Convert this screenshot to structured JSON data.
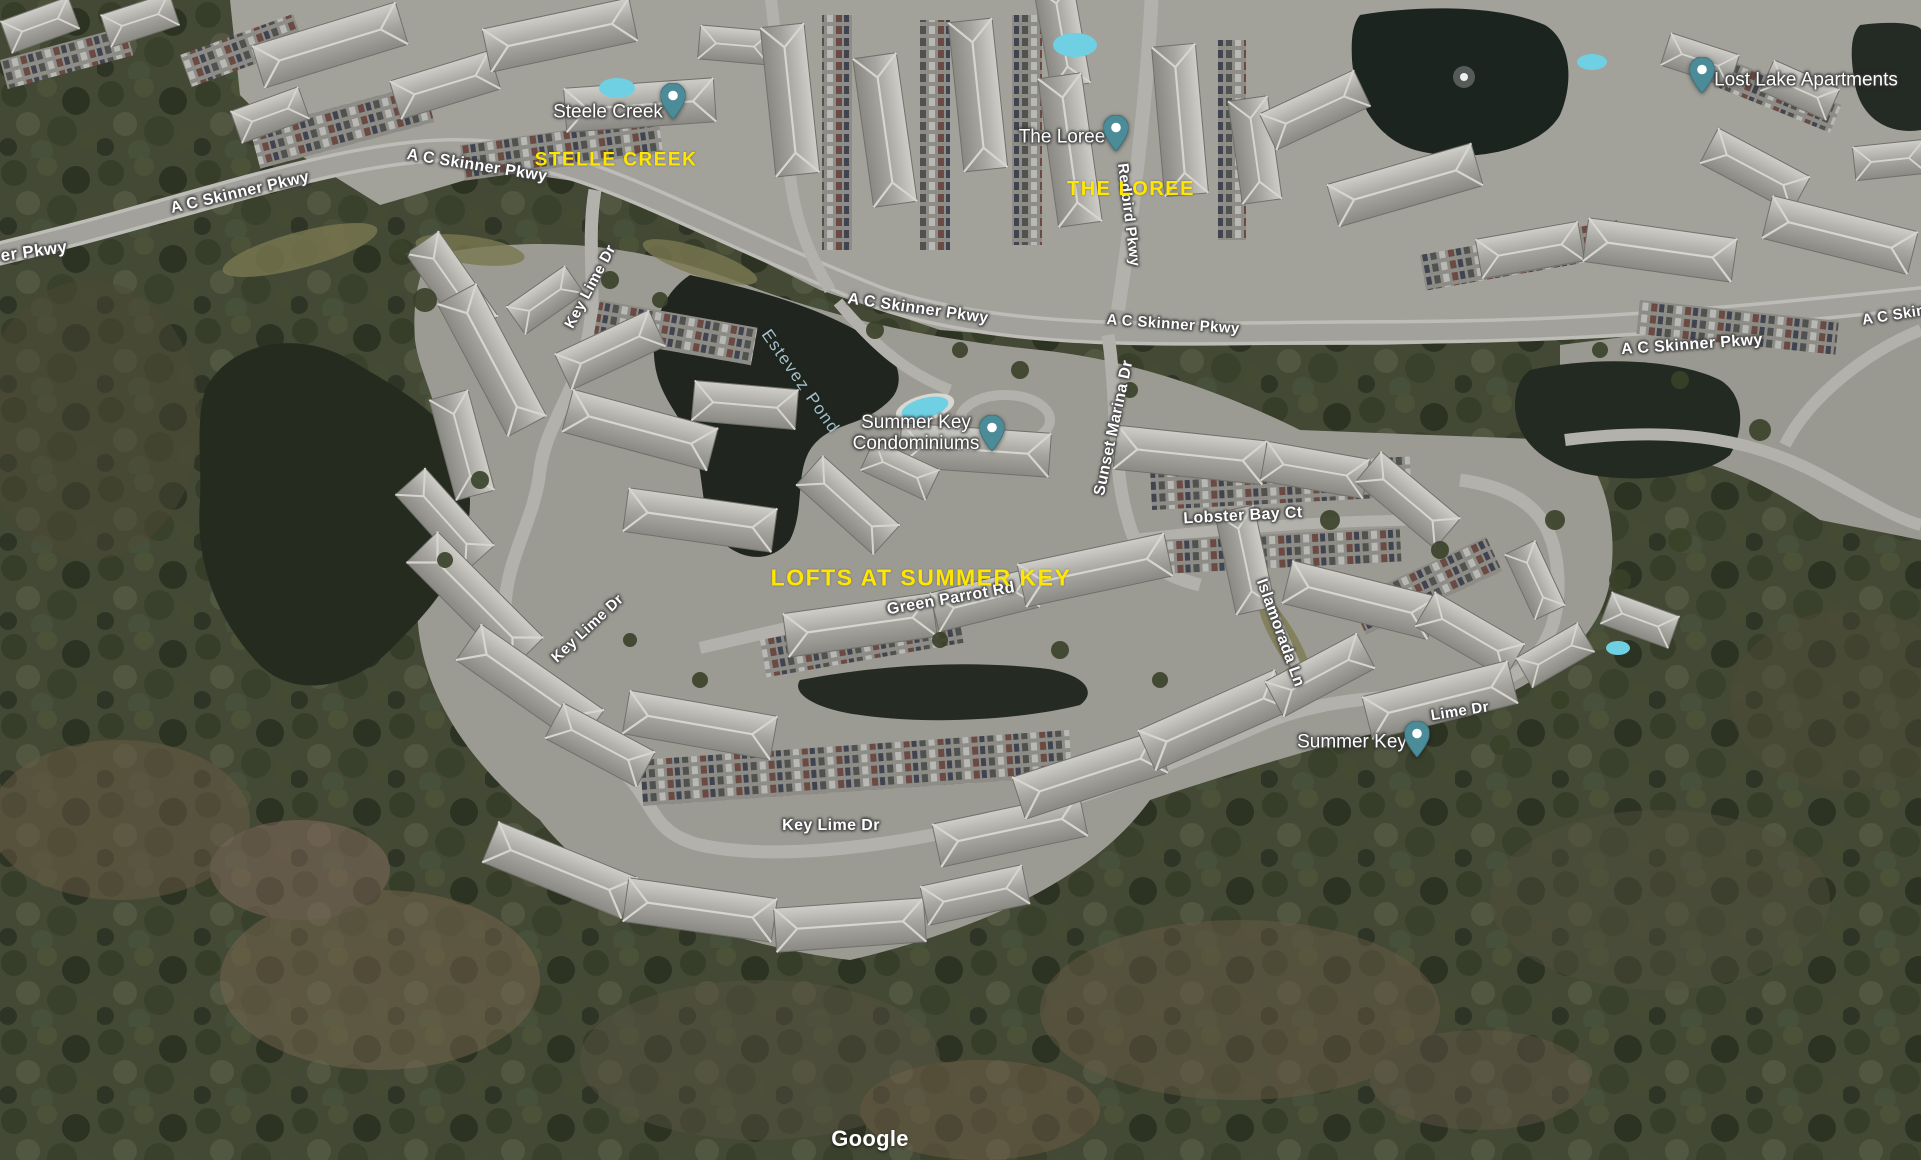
{
  "map": {
    "attribution": "Google",
    "colors": {
      "pin": "#4c8c98",
      "road_label": "#ffffff",
      "water_label": "#a7bfca",
      "annotation": "#ffe600"
    },
    "road_labels": [
      {
        "text": "er Pkwy",
        "x": 34,
        "y": 252,
        "rot": -8,
        "size": 17
      },
      {
        "text": "A C Skinner Pkwy",
        "x": 240,
        "y": 193,
        "rot": -13,
        "size": 16
      },
      {
        "text": "A C Skinner Pkwy",
        "x": 477,
        "y": 166,
        "rot": 9,
        "size": 16
      },
      {
        "text": "A C Skinner Pkwy",
        "x": 918,
        "y": 309,
        "rot": 8,
        "size": 16
      },
      {
        "text": "A C Skinner Pkwy",
        "x": 1173,
        "y": 325,
        "rot": 4,
        "size": 15
      },
      {
        "text": "A C Skinner Pkwy",
        "x": 1692,
        "y": 345,
        "rot": -4,
        "size": 16
      },
      {
        "text": "A C Skin",
        "x": 1894,
        "y": 316,
        "rot": -9,
        "size": 15
      },
      {
        "text": "Redbird Pkwy",
        "x": 1128,
        "y": 215,
        "rot": 83,
        "size": 15
      },
      {
        "text": "Key Lime Dr",
        "x": 591,
        "y": 287,
        "rot": -62,
        "size": 15
      },
      {
        "text": "Sunset Marina Dr",
        "x": 1114,
        "y": 428,
        "rot": -78,
        "size": 16
      },
      {
        "text": "Lobster Bay Ct",
        "x": 1243,
        "y": 516,
        "rot": -3,
        "size": 16
      },
      {
        "text": "Green Parrot Rd",
        "x": 951,
        "y": 599,
        "rot": -10,
        "size": 16
      },
      {
        "text": "Key Lime Dr",
        "x": 588,
        "y": 629,
        "rot": -43,
        "size": 15
      },
      {
        "text": "Key Lime Dr",
        "x": 831,
        "y": 826,
        "rot": 0,
        "size": 16
      },
      {
        "text": "Lime Dr",
        "x": 1460,
        "y": 712,
        "rot": -9,
        "size": 15
      },
      {
        "text": "Islamorada Ln",
        "x": 1280,
        "y": 633,
        "rot": 70,
        "size": 16
      }
    ],
    "water_labels": [
      {
        "text": "Estevez Pond",
        "x": 800,
        "y": 382,
        "rot": 55,
        "size": 17
      }
    ],
    "poi_markers": [
      {
        "lines": [
          "Steele Creek"
        ],
        "tx": 608,
        "ty": 113,
        "px": 673,
        "py": 124
      },
      {
        "lines": [
          "The Loree"
        ],
        "tx": 1062,
        "ty": 138,
        "px": 1116,
        "py": 156
      },
      {
        "lines": [
          "Lost Lake Apartments"
        ],
        "tx": 1806,
        "ty": 81,
        "px": 1702,
        "py": 98
      },
      {
        "lines": [
          "Summer Key",
          "Condominiums"
        ],
        "tx": 916,
        "ty": 434,
        "px": 992,
        "py": 456
      },
      {
        "lines": [
          "Summer Key"
        ],
        "tx": 1352,
        "ty": 743,
        "px": 1417,
        "py": 762
      }
    ],
    "annotations": [
      {
        "text": "STELLE CREEK",
        "x": 616,
        "y": 161,
        "size": 19
      },
      {
        "text": "THE LOREE",
        "x": 1131,
        "y": 189,
        "size": 20
      },
      {
        "text": "LOFTS AT SUMMER KEY",
        "x": 921,
        "y": 578,
        "size": 23
      }
    ]
  }
}
